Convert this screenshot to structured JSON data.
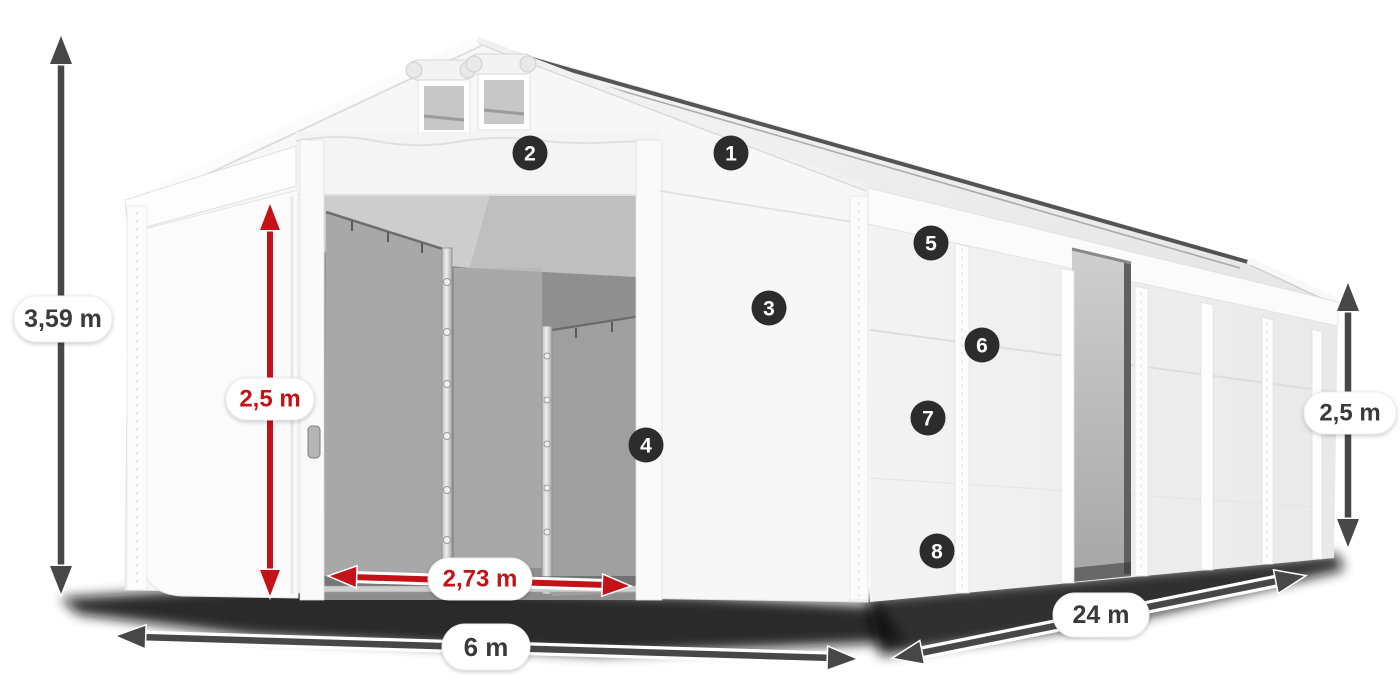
{
  "diagram": {
    "type": "product-dimension-diagram",
    "subject": "storage tent",
    "colors": {
      "dimension_red": "#c31218",
      "dimension_gray": "#474747",
      "badge_background": "#2c2c2c",
      "badge_text": "#ffffff",
      "tent_white": "#f7f7f7",
      "interior_gray": "#a8a8a8"
    },
    "dimensions": {
      "total_height": {
        "text": "3,59 m",
        "color": "gray"
      },
      "door_height": {
        "text": "2,5 m",
        "color": "red"
      },
      "door_width": {
        "text": "2,73 m",
        "color": "red"
      },
      "width": {
        "text": "6 m",
        "color": "gray"
      },
      "length": {
        "text": "24 m",
        "color": "gray"
      },
      "side_height": {
        "text": "2,5 m",
        "color": "gray"
      }
    },
    "callouts": [
      {
        "number": "1"
      },
      {
        "number": "2"
      },
      {
        "number": "3"
      },
      {
        "number": "4"
      },
      {
        "number": "5"
      },
      {
        "number": "6"
      },
      {
        "number": "7"
      },
      {
        "number": "8"
      }
    ]
  }
}
